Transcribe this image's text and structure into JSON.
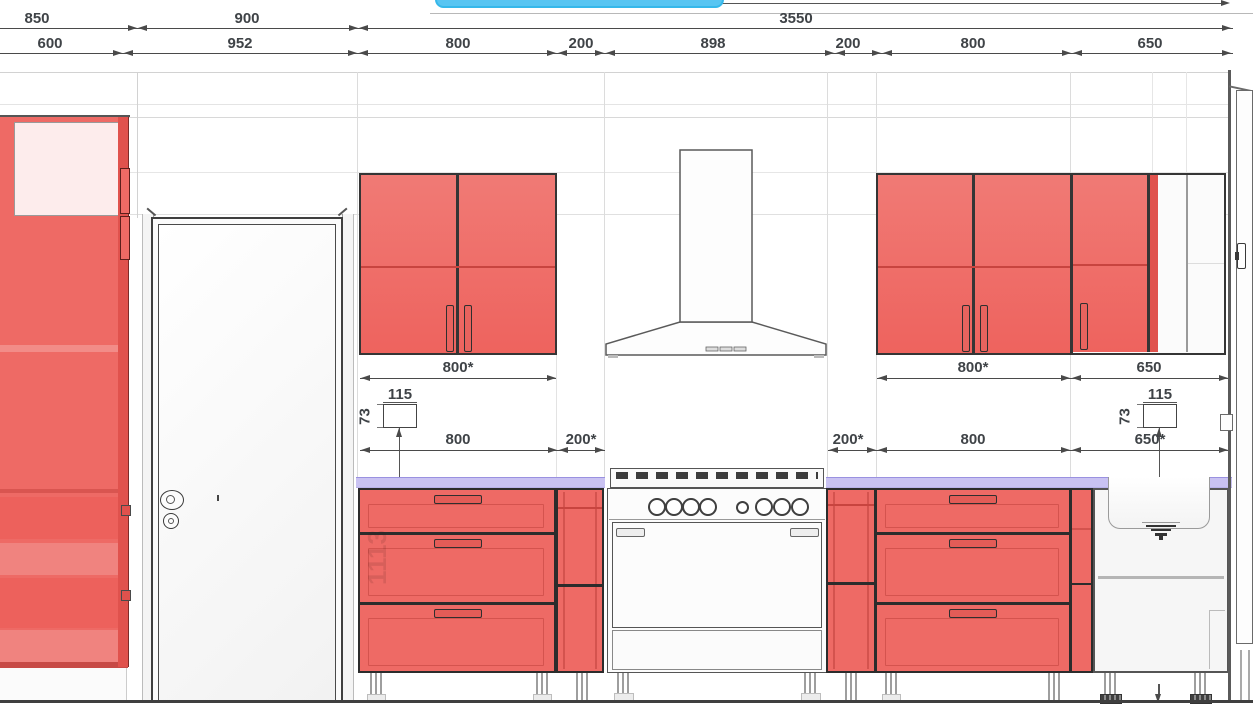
{
  "canvas": {
    "width": 1253,
    "height": 713,
    "view": "kitchen-elevation"
  },
  "colors": {
    "cabinet_red": "#ee6a65",
    "cabinet_red_dark": "#e0524d",
    "glass_pink": "#fdecec",
    "countertop_lavender": "#c9c2f2",
    "tooltip_blue": "#58c5f2",
    "dim_text": "#3f4347",
    "outline": "#3a3a3a",
    "floor_line": "#3f3f3f"
  },
  "dims": {
    "row1": {
      "d850": "850",
      "d900": "900",
      "d3550": "3550"
    },
    "row2": {
      "d600": "600",
      "d952": "952",
      "d800a": "800",
      "d200a": "200",
      "d898": "898",
      "d200b": "200",
      "d800b": "800",
      "d650": "650"
    },
    "upper": {
      "left800": "800*",
      "right800": "800*",
      "right650": "650"
    },
    "lower": {
      "left800": "800",
      "left200": "200*",
      "right200": "200*",
      "right800": "800",
      "right650": "650*"
    },
    "socket_left": {
      "width": "115",
      "height": "73"
    },
    "socket_right": {
      "width": "115",
      "height": "73"
    }
  },
  "watermark": {
    "code": "1113"
  }
}
